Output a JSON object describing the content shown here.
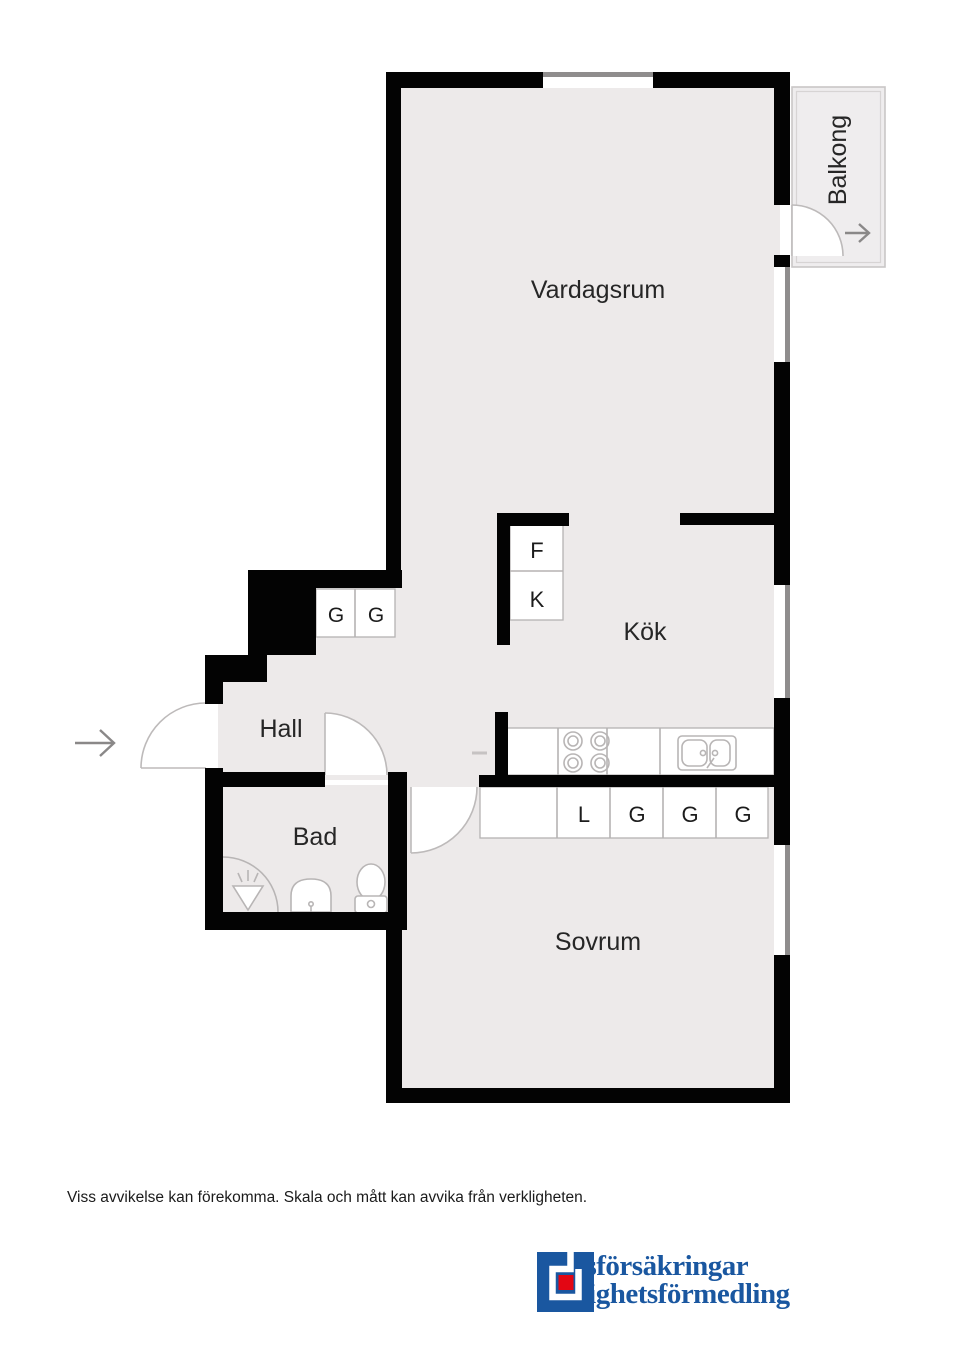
{
  "rooms": {
    "vardagsrum": "Vardagsrum",
    "kok": "Kök",
    "hall": "Hall",
    "bad": "Bad",
    "sovrum": "Sovrum",
    "balkong": "Balkong"
  },
  "closets": {
    "fridge": "F",
    "freezer": "K",
    "hall": [
      "G",
      "G"
    ],
    "bedroom": [
      "L",
      "G",
      "G",
      "G"
    ]
  },
  "footer": {
    "disclaimer": "Viss avvikelse kan förekomma. Skala och mått kan avvika från verkligheten."
  },
  "logo": {
    "line1": "Länsförsäkringar",
    "line2": "Fastighetsförmedling"
  },
  "colors": {
    "wall": "#030303",
    "floor": "#edeaea",
    "thin_line": "#b5b2b2",
    "logo_blue": "#1a57a0",
    "logo_red": "#e30613"
  }
}
